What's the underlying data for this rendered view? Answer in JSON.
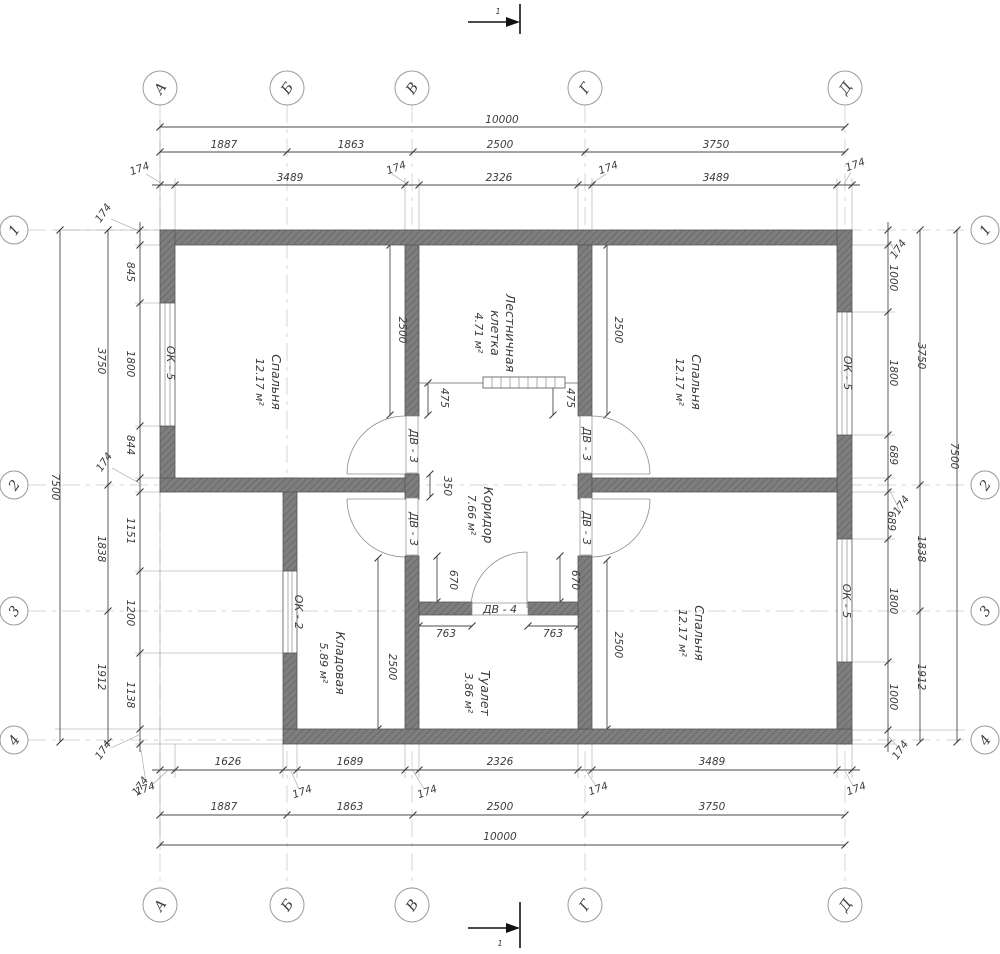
{
  "axes": {
    "cols": [
      "А",
      "Б",
      "В",
      "Г",
      "Д"
    ],
    "rows": [
      "1",
      "2",
      "3",
      "4"
    ]
  },
  "section": {
    "label": "1"
  },
  "rooms": {
    "bedroom_left": {
      "name": "Спальня",
      "area": "12.17 м²"
    },
    "bedroom_top_right": {
      "name": "Спальня",
      "area": "12.17 м²"
    },
    "bedroom_bottom_right": {
      "name": "Спальня",
      "area": "12.17 м²"
    },
    "stairwell": {
      "name_line1": "Лестничная",
      "name_line2": "клетка",
      "area": "4.71 м²"
    },
    "corridor": {
      "name": "Коридор",
      "area": "7.66 м²"
    },
    "pantry": {
      "name": "Кладовая",
      "area": "5.89 м²"
    },
    "toilet": {
      "name": "Туалет",
      "area": "3.86 м²"
    }
  },
  "openings": {
    "window_ok5": "ОК - 5",
    "window_ok2": "ОК - 2",
    "door_dv3": "ДВ - 3",
    "door_dv4": "ДВ - 4"
  },
  "dims": {
    "top": {
      "total": "10000",
      "spans": [
        "1887",
        "1863",
        "2500",
        "3750"
      ],
      "detail": [
        "174",
        "3489",
        "174",
        "2326",
        "174",
        "3489",
        "174"
      ]
    },
    "bottom": {
      "total": "10000",
      "spans": [
        "1887",
        "1863",
        "2500",
        "3750"
      ],
      "detail": [
        "174",
        "1626",
        "174",
        "1689",
        "174",
        "2326",
        "174",
        "3489",
        "174"
      ]
    },
    "left": {
      "total": "7500",
      "spans": [
        "3750",
        "1838",
        "1912"
      ],
      "detail": [
        "174",
        "845",
        "1800",
        "844",
        "174",
        "1151",
        "1200",
        "1138",
        "174",
        "174"
      ]
    },
    "right": {
      "total": "7500",
      "spans": [
        "3750",
        "1838",
        "1912"
      ],
      "detail": [
        "174",
        "1000",
        "1800",
        "689",
        "174",
        "689",
        "1800",
        "1000",
        "174"
      ]
    },
    "inner": {
      "depth": "2500",
      "stair": "475",
      "pier": "350",
      "corridor": "670",
      "toilet": "763"
    }
  }
}
